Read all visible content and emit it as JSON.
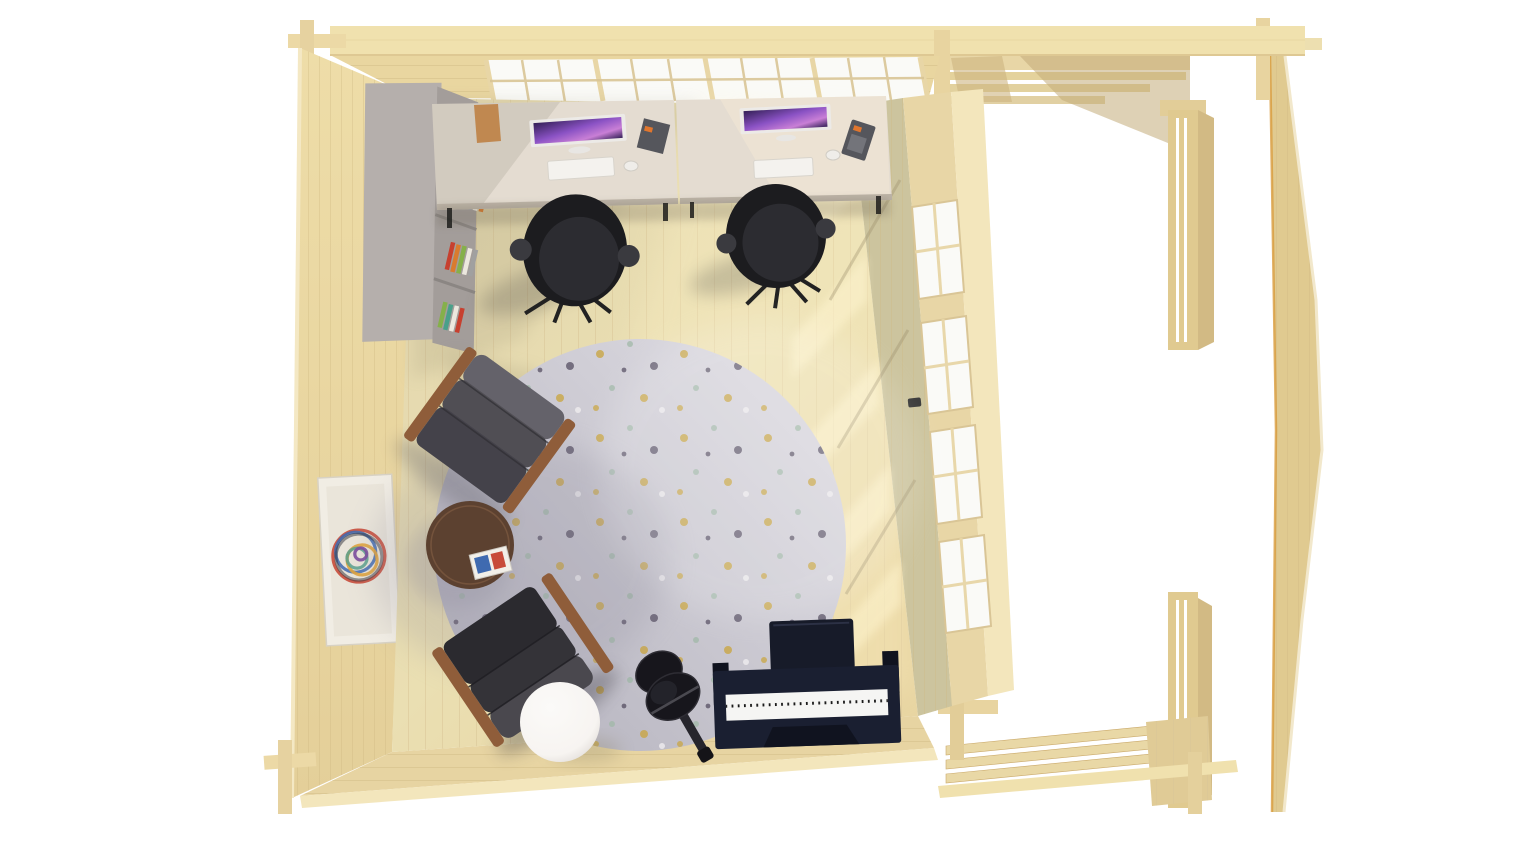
{
  "scene": {
    "description": "Bird's-eye 3D render of a log-cabin garden office with an attached open pergola terrace",
    "room_contents": "two desk workstations with monitors, two black office chairs, grey bookshelf with books, round speckled rug, two grey leather armchairs, round walnut coffee table with magazines, white sphere floor lamp, acoustic guitar on stand, digital piano with bench, framed wall art, glazed window-door wall",
    "terrace_contents": "open pergola frame: top beam, rafters, corner posts, gable end wall, floor joists",
    "background": "#ffffff"
  },
  "objects": {
    "desks": 2,
    "monitors": 2,
    "office_chairs": 2,
    "armchairs": 2,
    "windows_right_wall": 4,
    "rug": 1,
    "piano": 1,
    "guitar": 1,
    "floor_lamp": 1,
    "coffee_table": 1,
    "bookshelf": 1,
    "wall_art": 1
  },
  "colors": {
    "wood_beam": "#f0e1ae",
    "wood_wall": "#e9d6a0",
    "wood_wall_light": "#f3e6bc",
    "wood_edge": "#d6c08a",
    "wood_terrace": "#e0ca90",
    "wood_terrace_dark": "#caa96a",
    "gable_rim": "#d89b3c",
    "floor": "#eadfb2",
    "floor_plank_line": "#d8c596",
    "floor_shadow": "#8d8468",
    "floor_light": "#fff3c8",
    "stripe_light": "#fff6d2",
    "wall_interior_shaded": "#ccc49e",
    "glazing_wood": "#e8d6a6",
    "window_pane": "#fafaf7",
    "window_mullion": "#d9c596",
    "desk_top": "#e4dcd1",
    "desk_edge": "#bdb4a7",
    "monitor_frame": "#eceae7",
    "screen_a": "#8a52c4",
    "screen_b": "#c97fd6",
    "screen_c": "#342057",
    "keyboard": "#f4f2ee",
    "mouse": "#efede9",
    "chair_black": "#1c1c1f",
    "chair_black_light": "#2c2c31",
    "chair_armrest": "#3a3a3f",
    "shelf_top": "#b5afac",
    "shelf_front": "#a39d9a",
    "shelf_inner": "#8b8683",
    "rug_light": "#d9d7de",
    "rug_dark": "#b6b4bf",
    "armchair1": "#504e54",
    "armchair1_hi": "#64626a",
    "armchair2": "#343338",
    "armchair2_hi": "#4a484e",
    "armchair_wood": "#8f5d3a",
    "table_wood": "#5c4130",
    "lamp": "#f7f4f1",
    "guitar": "#17161c",
    "guitar_neck": "#26252c",
    "piano_body": "#1a1f31",
    "piano_dark": "#10131f",
    "piano_keys": "#f5f5f3",
    "bench": "#171b29",
    "art_frame": "#f1ede4",
    "art_mat": "#eae5da",
    "box_wood": "#c08850",
    "organizer": "#55565c",
    "organizer_accent": "#e0762e",
    "handle_metal": "#3a3a3a",
    "shadow_soft": "#6b6252",
    "shadow_cool": "#8f8c9c"
  },
  "palette": {
    "books": [
      "#c7402f",
      "#ece8de",
      "#dcb33c",
      "#85b04a",
      "#5f93cc",
      "#d97b2e",
      "#a0a0a0",
      "#4aa08a"
    ],
    "rug_speckles": [
      "#c9a53f",
      "#9fb8a6",
      "#514a5e",
      "#efedef"
    ],
    "art_scribble": [
      "#c84b3a",
      "#3f6ab0",
      "#e0a33c",
      "#58a08c",
      "#7a4a9c",
      "#2f2f38"
    ]
  }
}
